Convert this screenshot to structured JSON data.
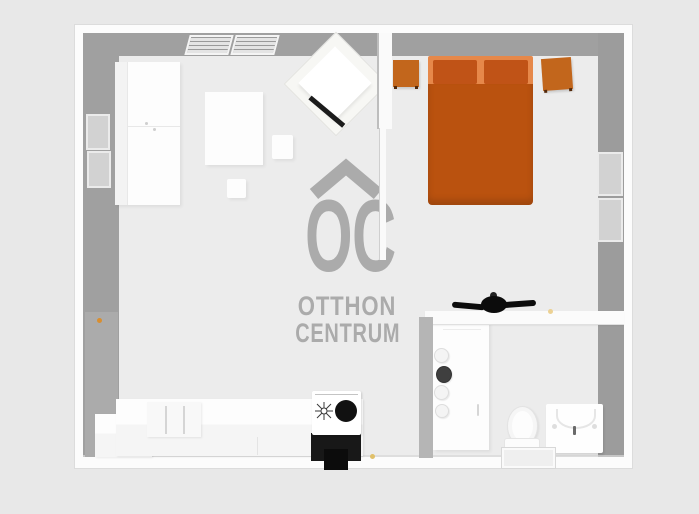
{
  "watermark": {
    "monogram": "OC",
    "line1": "OTTHON",
    "line2": "CENTRUM",
    "color": "#ababab"
  },
  "palette": {
    "background": "#e8e8e8",
    "floor": "#ececec",
    "wall_inner": "#a0a0a0",
    "wall_outer_white": "#fcfcfc",
    "bed_body_orange": "#ba520f",
    "pillow_orange": "#c05317",
    "bed_stripe_orange": "#e6884a",
    "nightstand_orange": "#c2661c",
    "appliance_black": "#181818",
    "door_handle_orange": "#d98e2f",
    "accent_dot_yellow": "#e0c06a",
    "watermark_gray": "#ababab"
  },
  "scene": {
    "type": "3d-floor-plan-top-view",
    "rooms": [
      {
        "name": "living-room-kitchen",
        "furniture": [
          "wardrobe",
          "window-with-blinds",
          "tv-stand",
          "rug-table",
          "side-chair",
          "stool",
          "kitchen-counter",
          "kitchen-cabinet",
          "stove",
          "oven",
          "radiator-window",
          "entry-door"
        ]
      },
      {
        "name": "bedroom",
        "furniture": [
          "double-bed",
          "nightstand-left",
          "nightstand-right",
          "window"
        ]
      },
      {
        "name": "bathroom",
        "furniture": [
          "ceiling-fan",
          "door-with-hooks",
          "toilet",
          "shower-tray",
          "washing-machine"
        ]
      }
    ]
  }
}
